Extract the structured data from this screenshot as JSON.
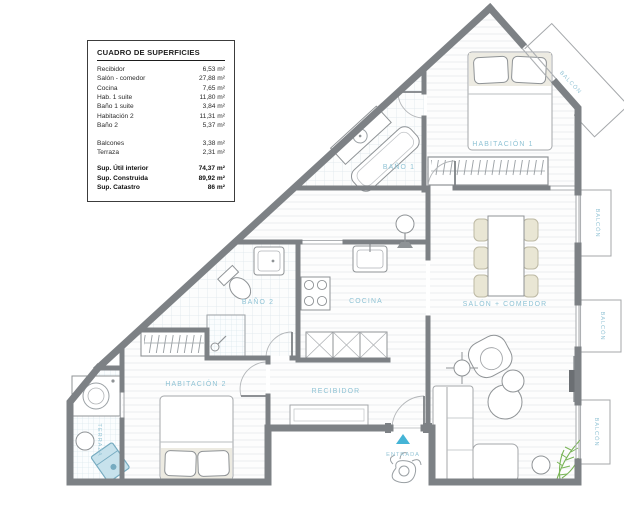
{
  "surface_table": {
    "title": "CUADRO DE SUPERFICIES",
    "rows": [
      {
        "label": "Recibidor",
        "value": "6,53 m²"
      },
      {
        "label": "Salón - comedor",
        "value": "27,88 m²"
      },
      {
        "label": "Cocina",
        "value": "7,65 m²"
      },
      {
        "label": "Hab. 1 suite",
        "value": "11,80 m²"
      },
      {
        "label": "Baño 1 suite",
        "value": "3,84 m²"
      },
      {
        "label": "Habitación 2",
        "value": "11,31 m²"
      },
      {
        "label": "Baño 2",
        "value": "5,37 m²"
      },
      {
        "label": "Balcones",
        "value": "3,38 m²"
      },
      {
        "label": "Terraza",
        "value": "2,31 m²"
      }
    ],
    "totals": [
      {
        "label": "Sup. Útil interior",
        "value": "74,37 m²"
      },
      {
        "label": "Sup. Construida",
        "value": "89,92 m²"
      },
      {
        "label": "Sup. Catastro",
        "value": "86 m²"
      }
    ]
  },
  "rooms": {
    "habitacion1": "HABITACIÓN 1",
    "bano1": "BAÑO 1",
    "salon_comedor": "SALÓN + COMEDOR",
    "cocina": "COCINA",
    "bano2": "BAÑO 2",
    "recibidor": "RECIBIDOR",
    "habitacion2": "HABITACIÓN 2",
    "terraza": "TERRAZA"
  },
  "balconies": [
    "BALCÓN",
    "BALCÓN",
    "BALCÓN",
    "BALCÓN"
  ],
  "entrance": {
    "label": "ENTRADA"
  },
  "colors": {
    "wall": "#7d8185",
    "room_label": "#8fc3d5",
    "entrance_arrow": "#45b4d6",
    "plant_green": "#79b456",
    "terrace_item": "#c7e2ec"
  }
}
